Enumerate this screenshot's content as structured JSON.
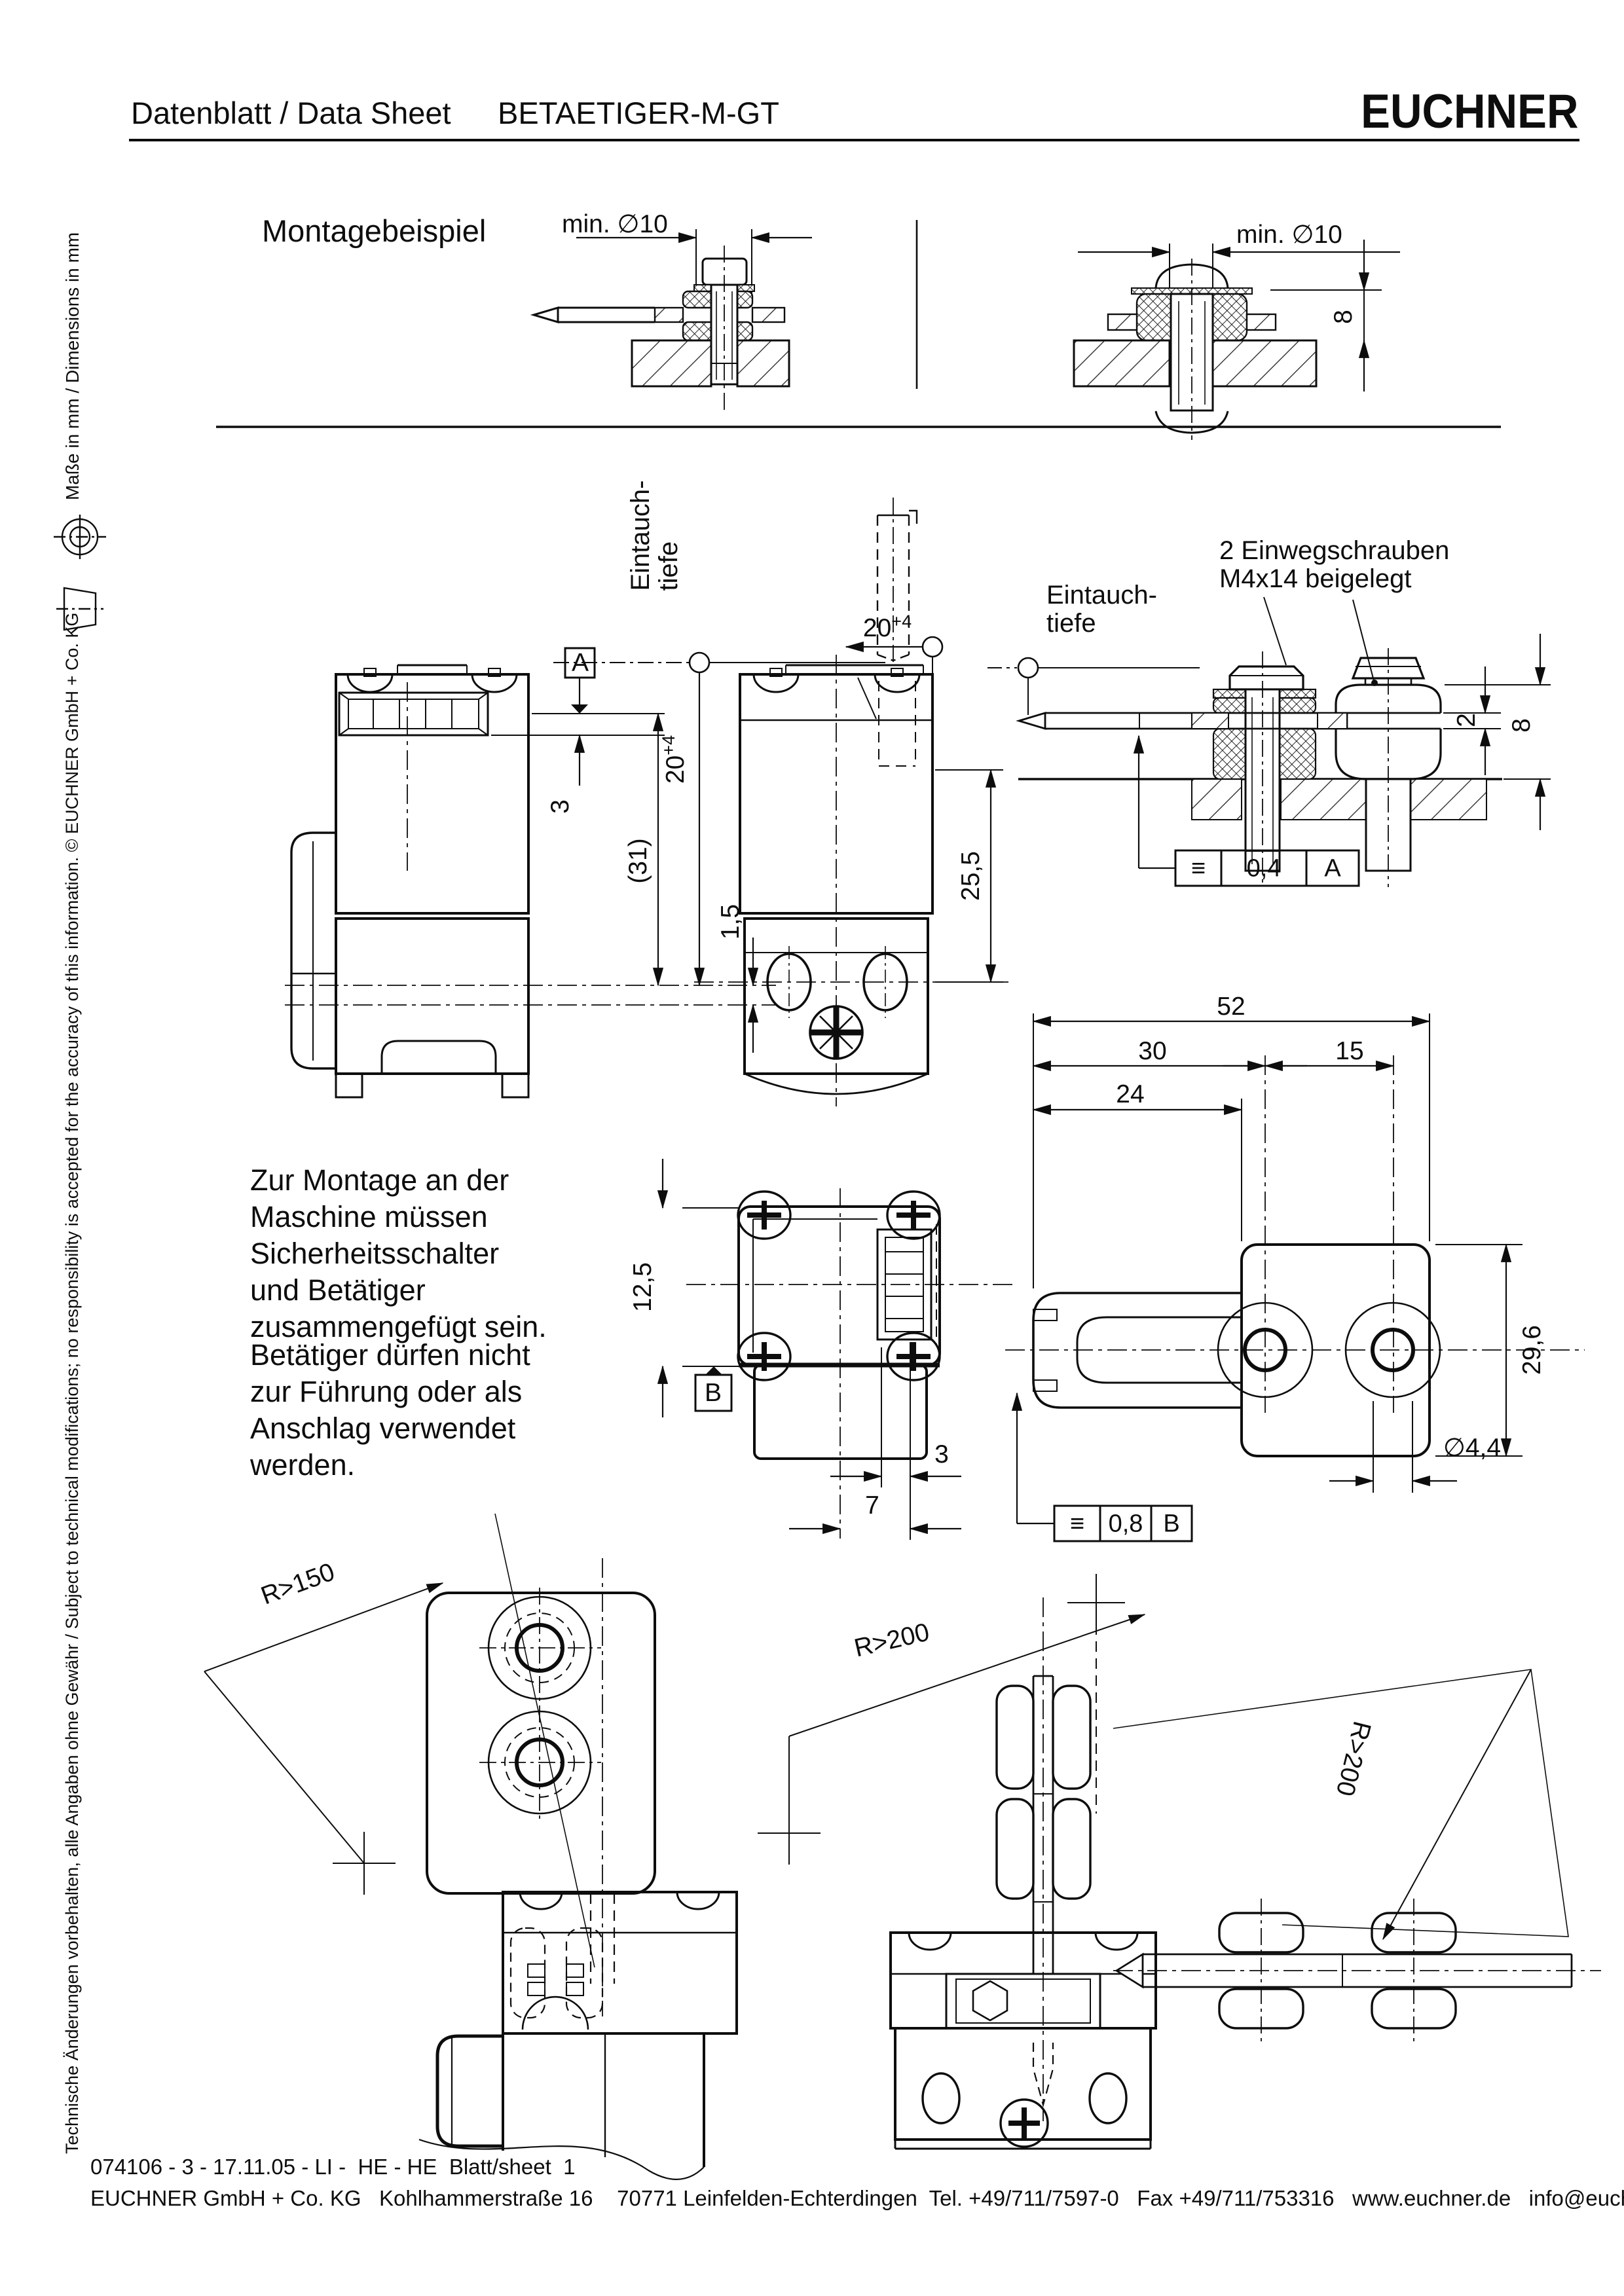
{
  "header": {
    "doc_type": "Datenblatt / Data Sheet",
    "product": "BETAETIGER-M-GT",
    "brand": "EUCHNER"
  },
  "sidebar": {
    "disclaimer": "Technische Änderungen vorbehalten, alle Angaben ohne Gewähr / Subject to technical modifications; no responsibility is accepted for the accuracy of this information.  © EUCHNER GmbH + Co. KG",
    "units": "Maße in mm / Dimensions in mm"
  },
  "montage": {
    "title": "Montagebeispiel",
    "dim_min_d10_left": "min. ∅10",
    "dim_min_d10_right": "min. ∅10",
    "dim_8": "8"
  },
  "views": {
    "immersion_vertical": "Eintauch-\ntiefe",
    "immersion_right": "Eintauch-\ntiefe",
    "screw_note": "2 Einwegschrauben\nM4x14 beigelegt",
    "dim_20": "20",
    "dim_20_tol": "+4",
    "datum_a": "A",
    "datum_b": "B",
    "dim_3_side": "3",
    "dim_31": "(31)",
    "dim_1_5": "1,5",
    "dim_25_5": "25,5",
    "dim_2": "2",
    "dim_8": "8",
    "tol_frame_a": {
      "symbol": "≡",
      "value": "0,4",
      "datum": "A"
    },
    "tol_frame_b": {
      "symbol": "≡",
      "value": "0,8",
      "datum": "B"
    },
    "dim_52": "52",
    "dim_30": "30",
    "dim_15": "15",
    "dim_24": "24",
    "dim_29_6": "29,6",
    "dim_d4_4": "∅4,4",
    "dim_12_5": "12,5",
    "dim_3_top": "3",
    "dim_7": "7",
    "radius_150": "R>150",
    "radius_200_a": "R>200",
    "radius_200_b": "R>200"
  },
  "notes": {
    "para1": "Zur Montage an der\nMaschine müssen\nSicherheitsschalter\nund Betätiger\nzusammengefügt sein.",
    "para2": "Betätiger dürfen nicht\nzur Führung oder als\nAnschlag verwendet\nwerden."
  },
  "footer": {
    "doc_line": "074106 - 3 - 17.11.05 - LI -  HE - HE  Blatt/sheet  1",
    "address": "EUCHNER GmbH + Co. KG   Kohlhammerstraße 16    70771 Leinfelden-Echterdingen  Tel. +49/711/7597-0   Fax +49/711/753316   www.euchner.de   info@euchner.de"
  }
}
